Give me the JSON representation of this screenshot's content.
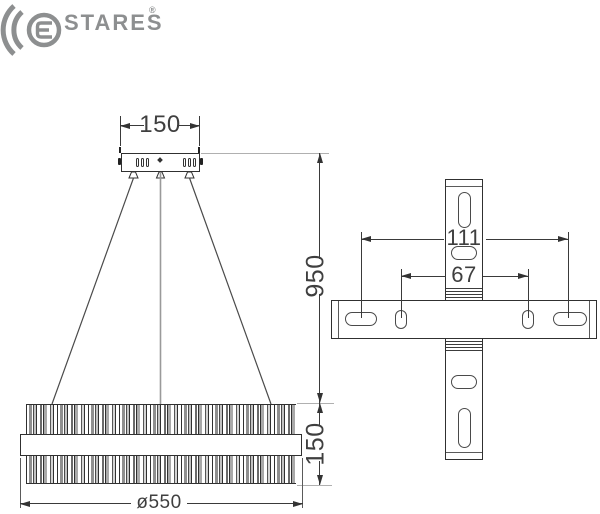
{
  "brand": {
    "icon": "concentric-arcs-with-e",
    "wordmark_rest": "STARES",
    "registered": "®",
    "logo_color": "#8d8f90"
  },
  "colors": {
    "outline": "#303030",
    "dimension_line": "#3a3a3a",
    "helper_line": "#b0b0b0",
    "text": "#3f3f3f"
  },
  "front_view": {
    "canopy_width_label": "150",
    "suspension_height_label": "950",
    "body_height_label": "150",
    "diameter_label": "ø550"
  },
  "top_view": {
    "outer_span_label": "111",
    "inner_span_label": "67"
  }
}
